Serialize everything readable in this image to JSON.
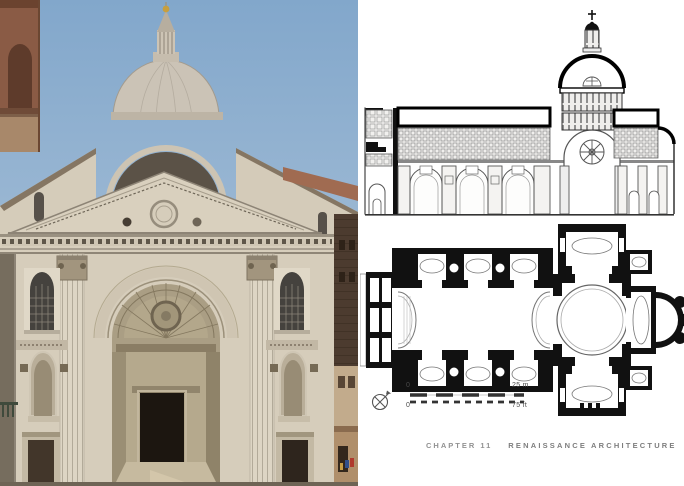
{
  "page": {
    "background": "#ffffff",
    "caption": {
      "chapter": "CHAPTER 11",
      "title": "RENAISSANCE ARCHITECTURE"
    }
  },
  "scale_bar": {
    "meters_zero": "0",
    "meters_max": "25 m",
    "feet_zero": "0",
    "feet_max": "75 ft"
  },
  "icons": {
    "compass": "north-arrow-compass-icon"
  },
  "colors": {
    "sky": "#87abce",
    "facade_stone": "#d6cdbb",
    "brick_tower": "#8a5b45",
    "dark_neighbor": "#4c3b2f",
    "window_glass": "#3a444f",
    "drawing_ink": "#333333",
    "caption_gray": "#8c8c8c"
  }
}
